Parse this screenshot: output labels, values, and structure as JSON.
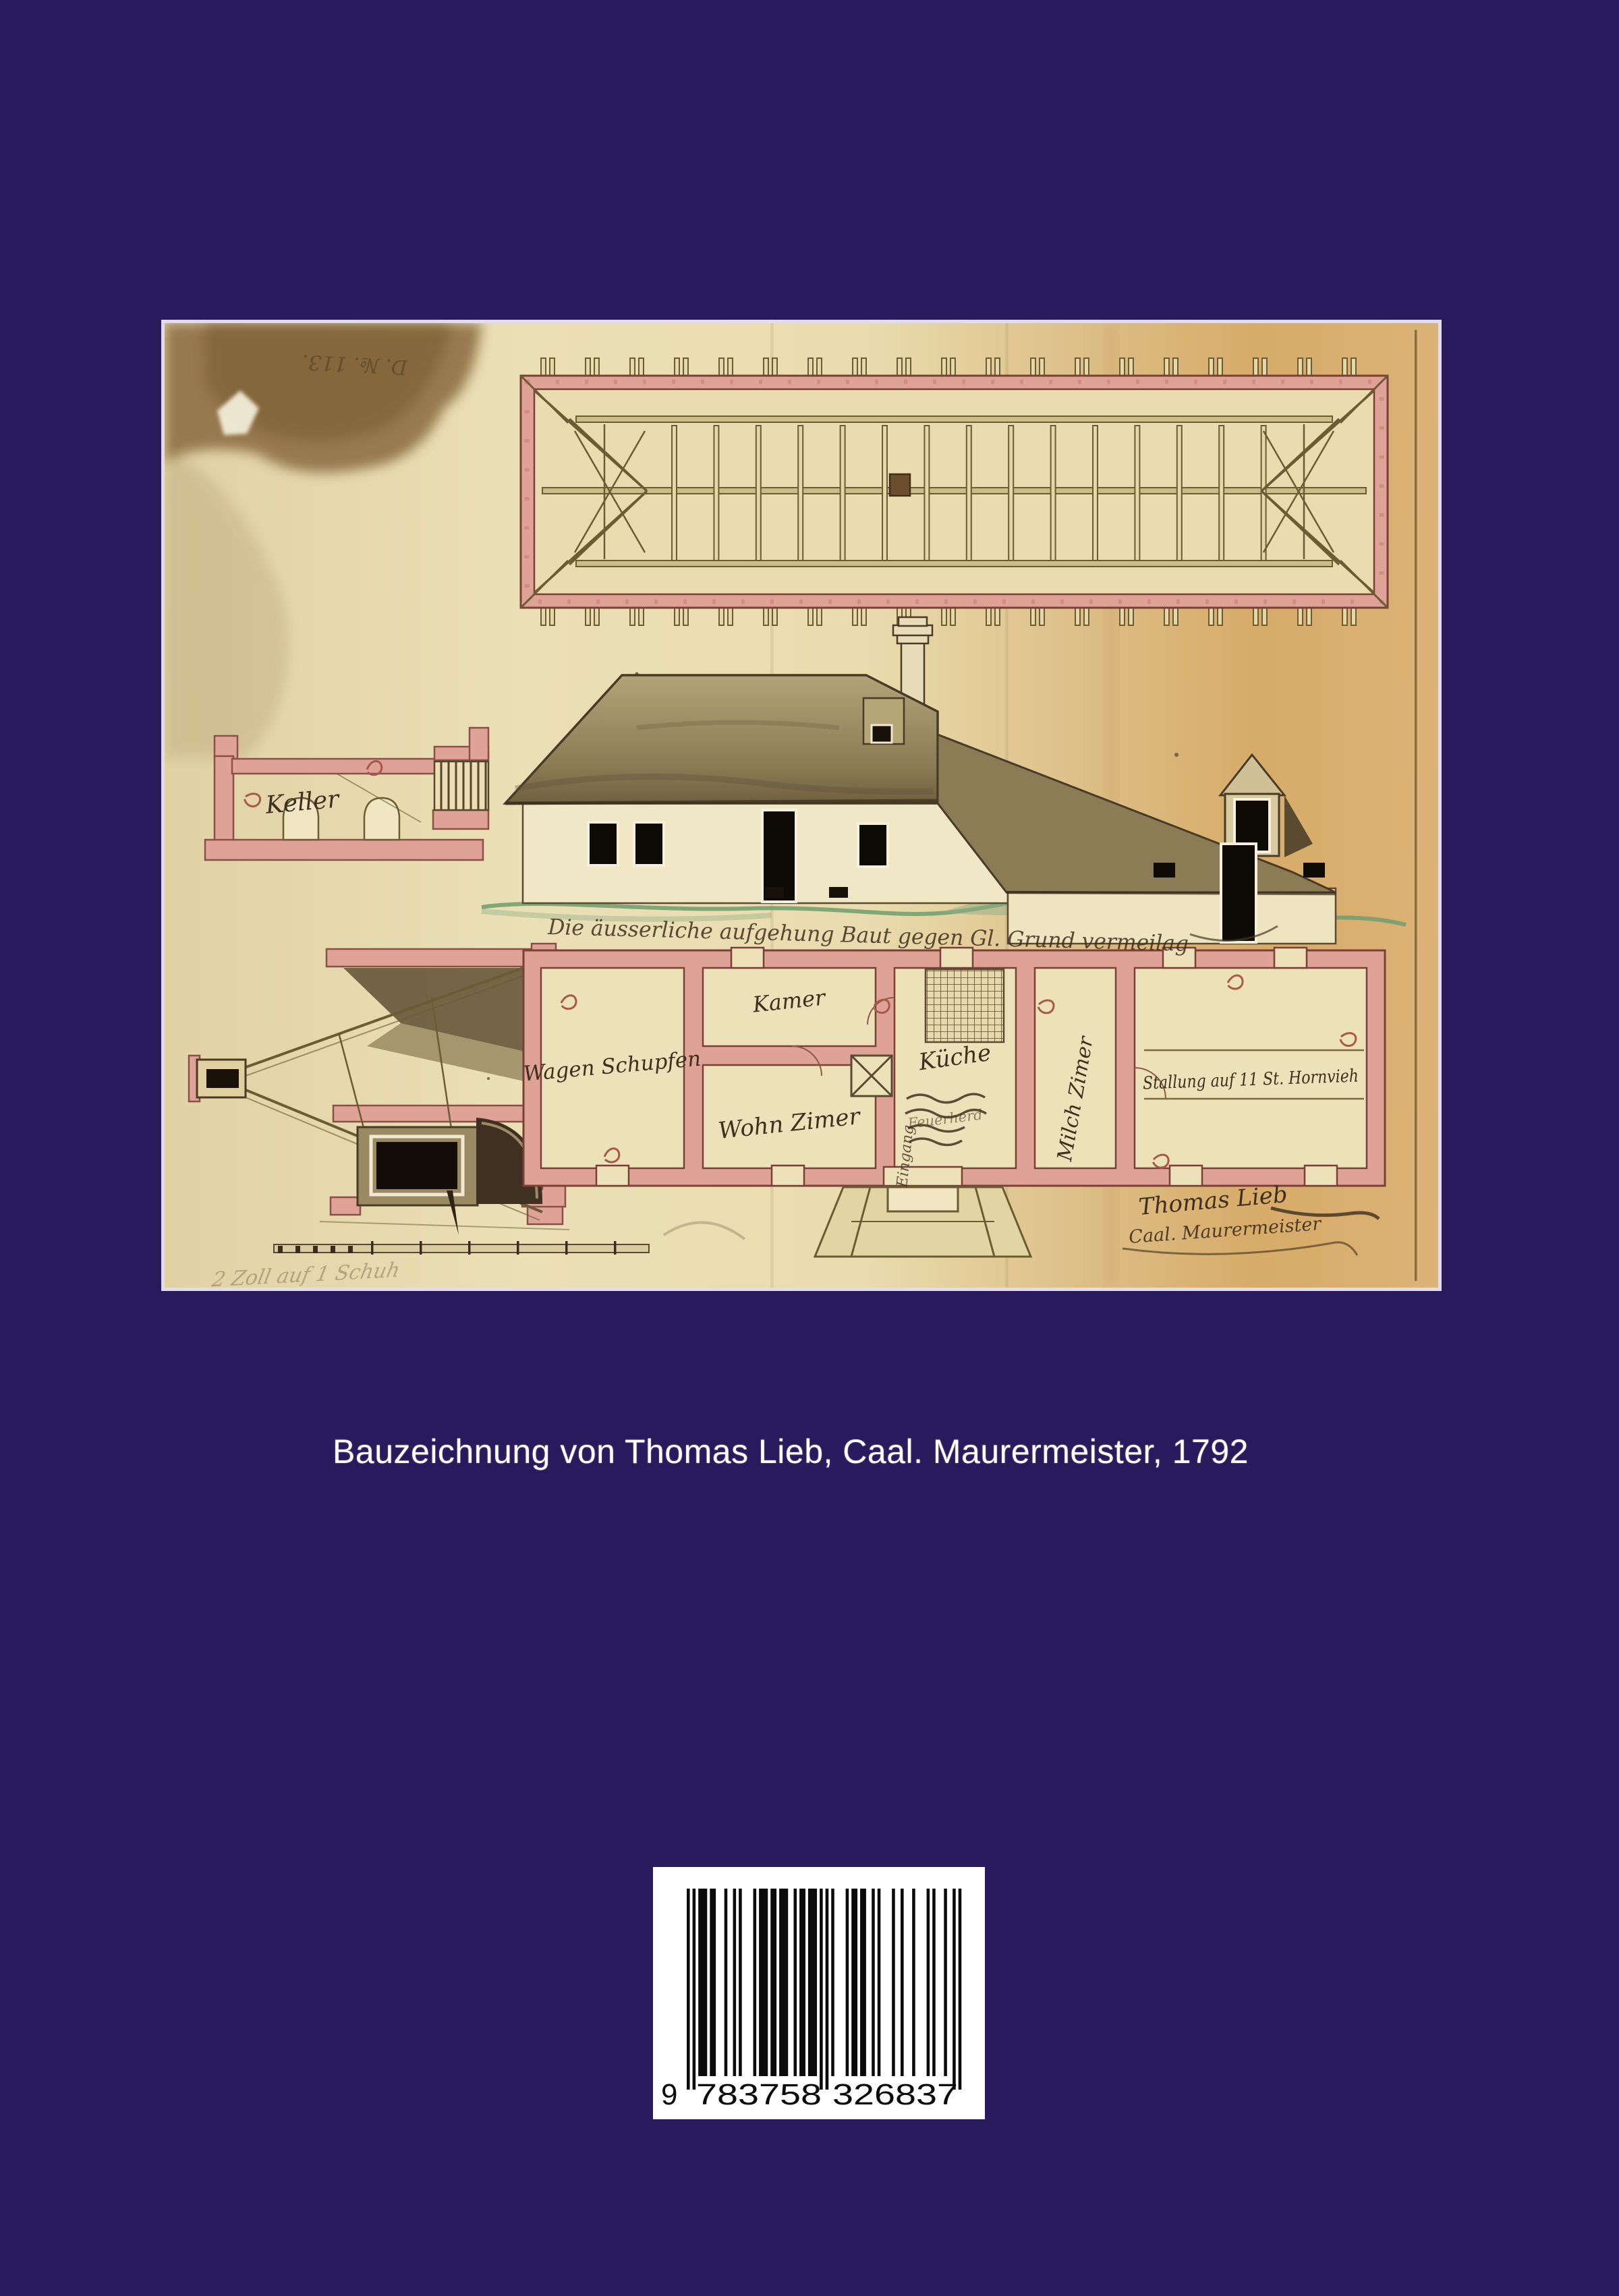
{
  "theme": {
    "page_bg": "#281a5c",
    "photo_border": "#dfdcf0",
    "paper_base": "#e7daae",
    "paper_warm": "#d9ad6e",
    "wall_pink": "#dfa296",
    "wall_outline": "#7a4038",
    "ink_brown": "#3f2f1e",
    "beam_olive": "#6b5c33",
    "roof_olive": "#8c7c55",
    "ground_green": "#6f9e6f",
    "caption_color": "#ffffff",
    "barcode_bg": "#ffffff",
    "bar_color": "#0b0b0b"
  },
  "caption": {
    "text": "Bauzeichnung von Thomas Lieb, Caal. Maurermeister, 1792"
  },
  "artwork": {
    "archive_note": "D. №. 113.",
    "inscription": "Die äusserliche aufgehung Baut gegen Gl. Grund vermeilag",
    "rooms": {
      "keller": "Keller",
      "wagen_schupfen": "Wagen Schupfen",
      "kamer": "Kamer",
      "wohn_zimer": "Wohn Zimer",
      "kueche": "Küche",
      "milch_zimer": "Milch Zimer",
      "stallung": "Stallung auf 11 St. Hornvieh",
      "eingang": "Eingang",
      "herd": "Feuerherd"
    },
    "signature": {
      "line1": "Thomas Lieb",
      "line2": "Caal. Maurermeister"
    },
    "scale_note": "2 Zoll auf 1 Schuh"
  },
  "barcode": {
    "value": "9783758326837",
    "groups": [
      "9",
      "783758",
      "326837"
    ]
  }
}
